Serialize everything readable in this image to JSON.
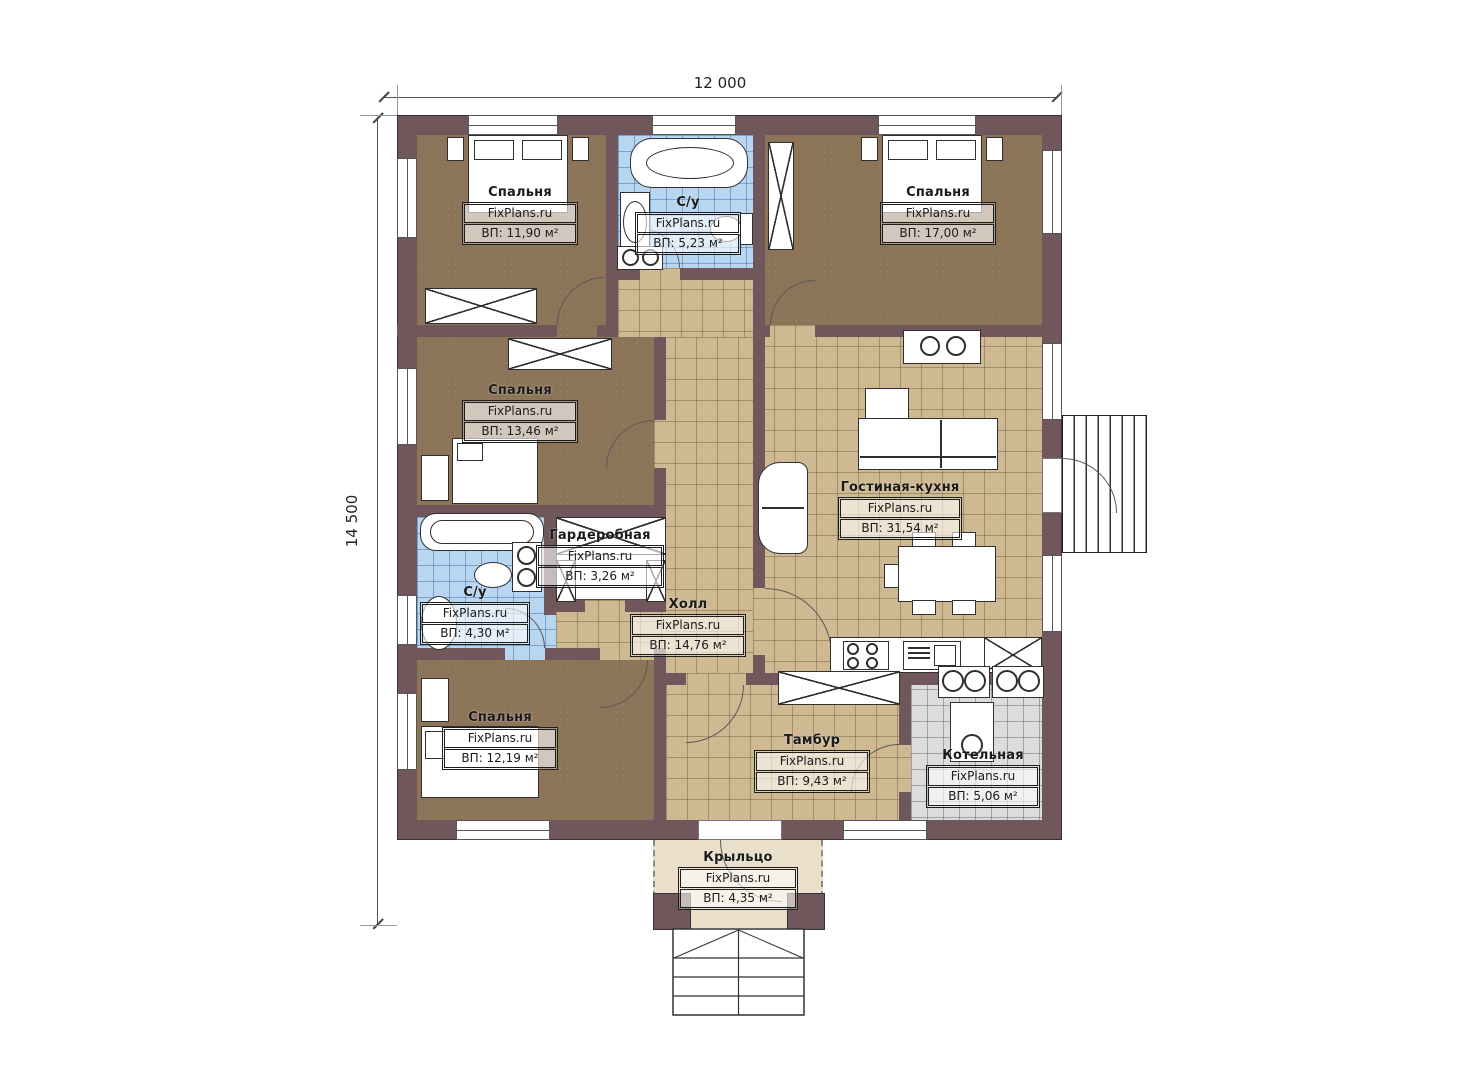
{
  "dimensions": {
    "top": "12 000",
    "left": "14 500"
  },
  "brand": "FixPlans.ru",
  "colors": {
    "wall": "#6F575B",
    "bedroom_floor": "#8C7458",
    "tile_floor": "#CFB992",
    "bath_tile": "#B9D6F0",
    "boiler_tile": "#DCDCDC",
    "porch_floor": "#E9DFCA",
    "furniture": "#FFFFFF",
    "line": "#2F2F2F"
  },
  "rooms": [
    {
      "name": "Спальня",
      "brand": "FixPlans.ru",
      "area": "ВП: 11,90 м²"
    },
    {
      "name": "С/у",
      "brand": "FixPlans.ru",
      "area": "ВП: 5,23 м²"
    },
    {
      "name": "Спальня",
      "brand": "FixPlans.ru",
      "area": "ВП: 17,00 м²"
    },
    {
      "name": "Спальня",
      "brand": "FixPlans.ru",
      "area": "ВП: 13,46 м²"
    },
    {
      "name": "Гостиная-кухня",
      "brand": "FixPlans.ru",
      "area": "ВП: 31,54 м²"
    },
    {
      "name": "Гардеробная",
      "brand": "FixPlans.ru",
      "area": "ВП: 3,26 м²"
    },
    {
      "name": "С/у",
      "brand": "FixPlans.ru",
      "area": "ВП: 4,30 м²"
    },
    {
      "name": "Холл",
      "brand": "FixPlans.ru",
      "area": "ВП: 14,76 м²"
    },
    {
      "name": "Спальня",
      "brand": "FixPlans.ru",
      "area": "ВП: 12,19 м²"
    },
    {
      "name": "Тамбур",
      "brand": "FixPlans.ru",
      "area": "ВП: 9,43 м²"
    },
    {
      "name": "Котельная",
      "brand": "FixPlans.ru",
      "area": "ВП: 5,06 м²"
    },
    {
      "name": "Крыльцо",
      "brand": "FixPlans.ru",
      "area": "ВП: 4,35 м²"
    }
  ]
}
